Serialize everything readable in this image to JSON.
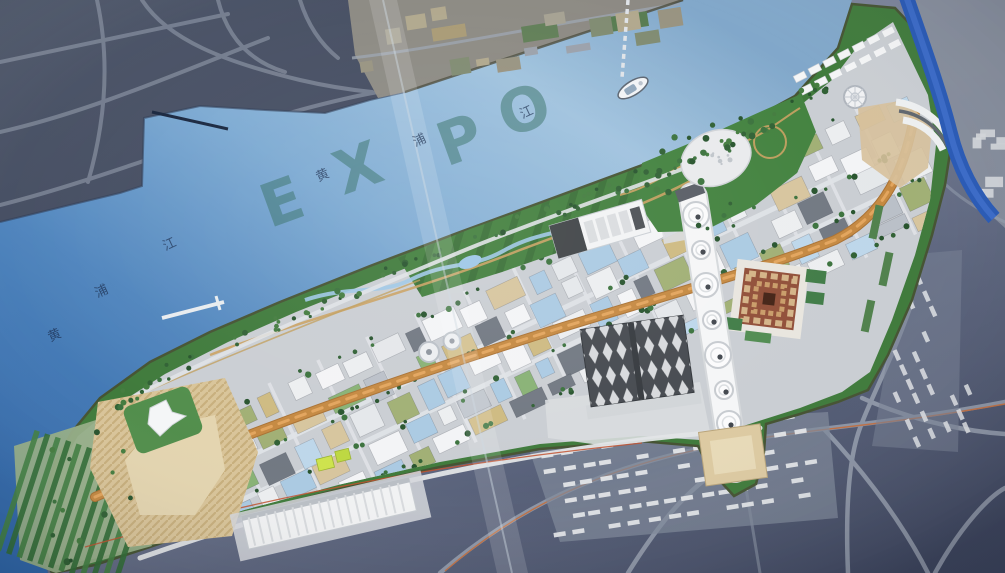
{
  "scene": {
    "watermark": {
      "letters": [
        "E",
        "X",
        "P",
        "O"
      ]
    },
    "river_labels": {
      "upper": [
        "黄",
        "浦",
        "江"
      ],
      "lower": [
        "黄",
        "浦",
        "江"
      ]
    },
    "icons": {
      "boat": "ferry-boat-icon",
      "pier": "ferry-pier-icon",
      "bridge": "bridge-band"
    },
    "palette": {
      "river": "#4e84bd",
      "park_green": "#3c7838",
      "urban_plaza": "#c9cdd2",
      "boulevard_orange": "#c4873e",
      "canal_blue": "#2456b4",
      "china_pavilion_red": "#8f4c35",
      "watermark_text": "#2f6b5e",
      "dark_land": "#3a4257",
      "metro_line": "#c26a38"
    }
  }
}
